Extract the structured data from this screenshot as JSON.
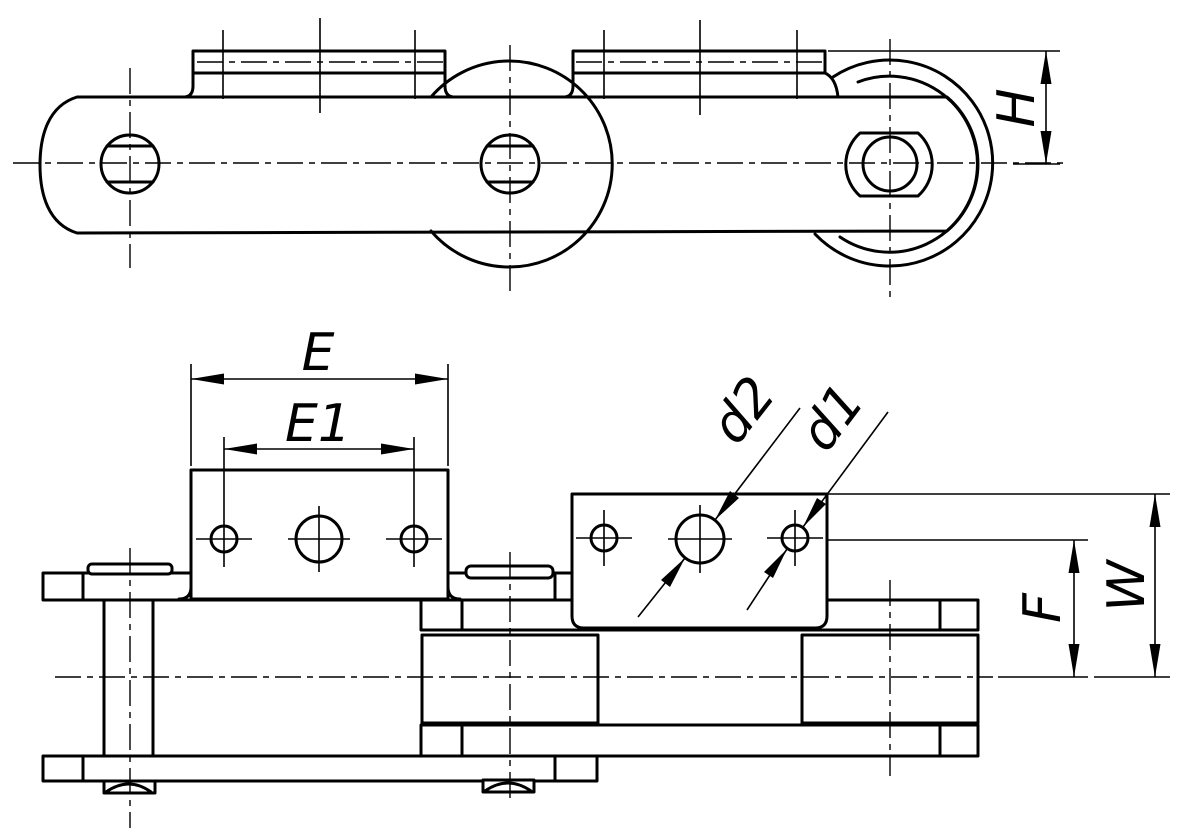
{
  "drawing": {
    "title": "Conveyor roller chain with bent attachment plates — two orthographic views",
    "background_color": "#ffffff",
    "line_color": "#000000",
    "views": {
      "top": "side elevation of chain with attachment platforms and hex pin end",
      "bottom": "plan view of chain with two bent attachment plates shown face-on"
    },
    "labels": {
      "H": "H",
      "E": "E",
      "E1": "E1",
      "d2": "d2",
      "d1": "d1",
      "F": "F",
      "W": "W"
    },
    "dimensions": [
      {
        "label": "H",
        "type": "vertical",
        "meaning": "attachment platform height above chain centerline"
      },
      {
        "label": "E",
        "type": "horizontal",
        "meaning": "attachment plate overall width"
      },
      {
        "label": "E1",
        "type": "horizontal",
        "meaning": "attachment hole spacing"
      },
      {
        "label": "d2",
        "type": "diameter",
        "meaning": "large attachment hole diameter"
      },
      {
        "label": "d1",
        "type": "diameter",
        "meaning": "small attachment hole diameter"
      },
      {
        "label": "F",
        "type": "vertical",
        "meaning": "hole axis height above chain centerline"
      },
      {
        "label": "W",
        "type": "vertical",
        "meaning": "attachment plate top height above chain centerline"
      }
    ]
  }
}
